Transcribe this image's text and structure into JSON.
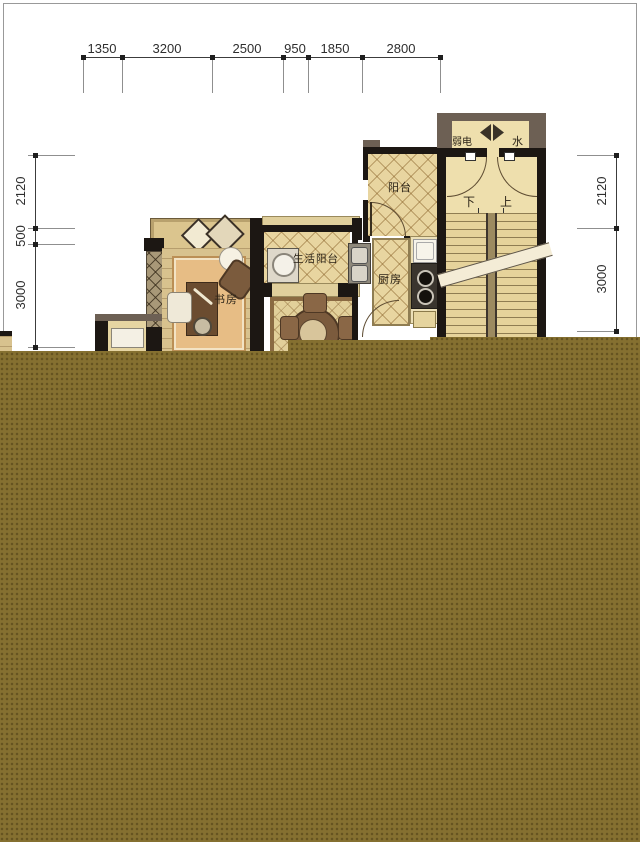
{
  "annotations": {
    "top_dims": [
      "1350",
      "3200",
      "2500",
      "950",
      "1850",
      "2800"
    ],
    "left_dims": [
      "2120",
      "500",
      "3000"
    ],
    "right_dims": [
      "2120",
      "3000"
    ]
  },
  "rooms": {
    "study": "书房",
    "service_balcony": "生活阳台",
    "kitchen": "厨房",
    "balcony": "阳台",
    "weak_electric": "弱电",
    "water": "水",
    "stair_down": "下",
    "stair_up": "上"
  },
  "colors": {
    "redaction_block": "#857030",
    "wall": "#1c1713",
    "outer_wall_gray": "#6d6054",
    "floor_tan": "#e8d5a0"
  }
}
